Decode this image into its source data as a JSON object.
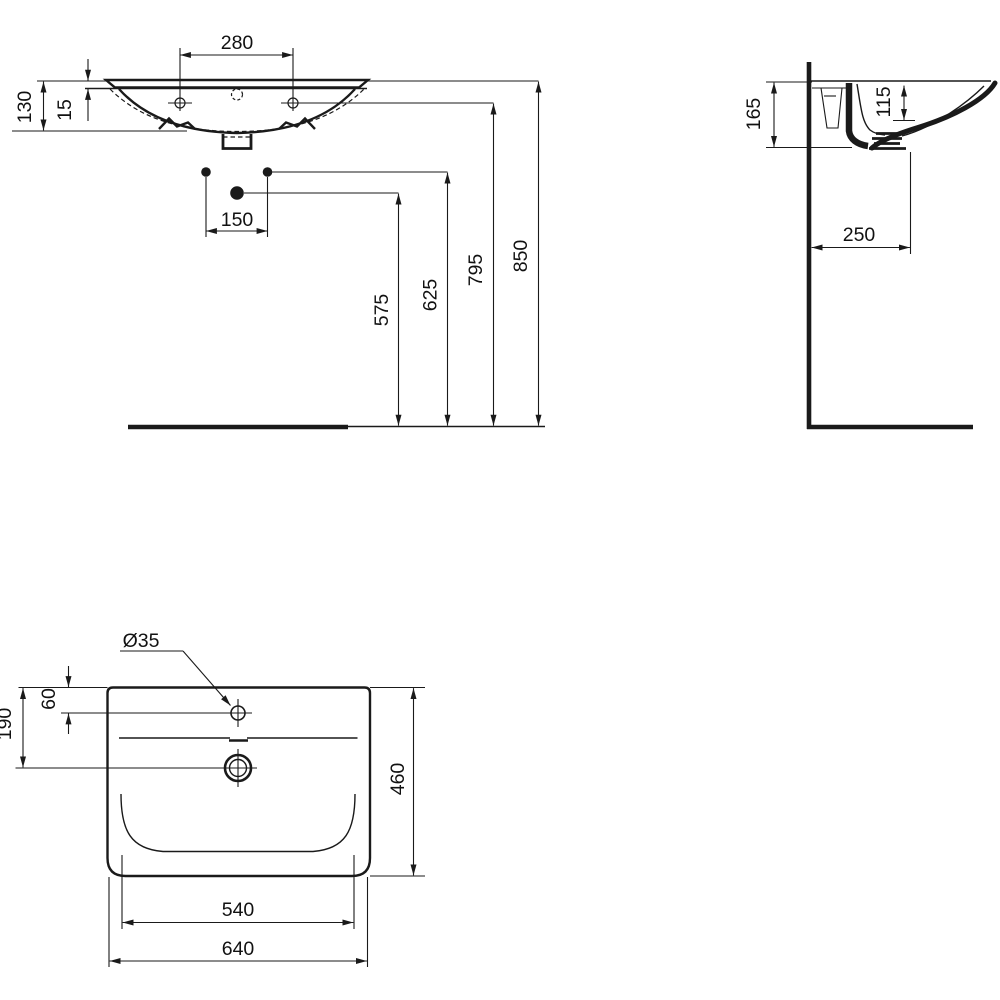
{
  "drawing": {
    "type": "technical-dimension-drawing",
    "subject": "wall-hung washbasin, three orthographic views",
    "line_color": "#1a1a1a",
    "background": "#ffffff"
  },
  "views": {
    "front": {
      "name": "front elevation",
      "dims": {
        "tap_spacing": "280",
        "basin_height": "130",
        "rim_thickness": "15",
        "outlet_spacing": "150",
        "trap_outlet_height": "575",
        "supply_height": "625",
        "fixing_hole_height": "795",
        "rim_top_height": "850"
      }
    },
    "side": {
      "name": "side section",
      "dims": {
        "basin_total_depth": "165",
        "bowl_inner_depth": "115",
        "outlet_wall_distance": "250"
      }
    },
    "plan": {
      "name": "plan view",
      "dims": {
        "tap_hole_diameter": "Ø35",
        "tap_hole_offset": "60",
        "outlet_offset": "190",
        "overall_depth": "460",
        "bowl_inner_width": "540",
        "overall_width": "640"
      }
    }
  }
}
